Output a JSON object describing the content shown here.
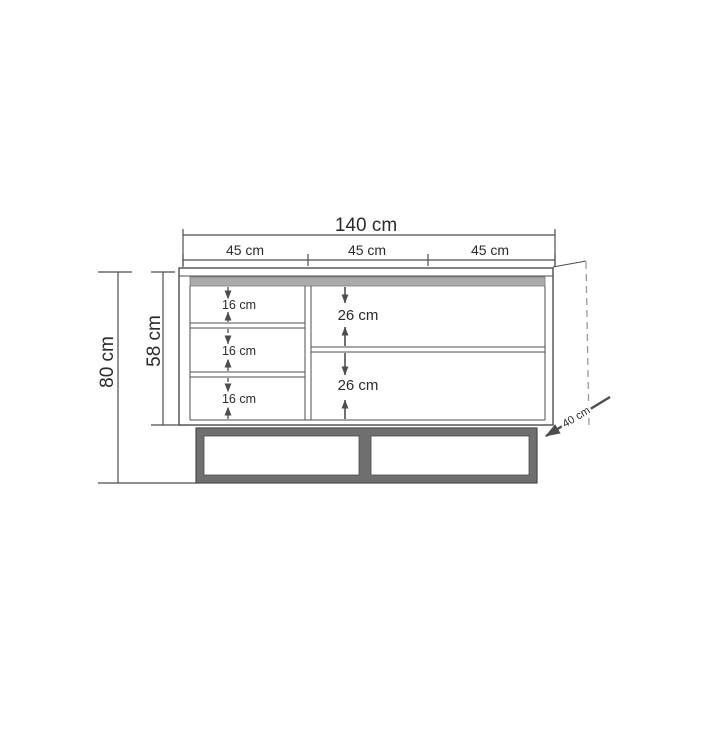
{
  "figure": {
    "type": "furniture-dimension-diagram",
    "subject": "tv-stand-sideboard-front-elevation",
    "unit": "cm",
    "width_total": {
      "label": "140 cm",
      "value": 140
    },
    "width_sections": [
      {
        "label": "45 cm",
        "value": 45
      },
      {
        "label": "45 cm",
        "value": 45
      },
      {
        "label": "45 cm",
        "value": 45
      }
    ],
    "height_total": {
      "label": "80 cm",
      "value": 80
    },
    "height_body": {
      "label": "58 cm",
      "value": 58
    },
    "depth": {
      "label": "40 cm",
      "value": 40
    },
    "left_compartments": [
      {
        "label": "16 cm",
        "value": 16
      },
      {
        "label": "16 cm",
        "value": 16
      },
      {
        "label": "16 cm",
        "value": 16
      }
    ],
    "right_compartments": [
      {
        "label": "26 cm",
        "value": 26
      },
      {
        "label": "26 cm",
        "value": 26
      }
    ],
    "colors": {
      "background": "#ffffff",
      "line": "#4d4d4d",
      "text": "#2b2b2b",
      "top_strip": "#ababab",
      "base_frame": "#6f6f6f",
      "edge_dash": "#9a9a9a"
    }
  }
}
